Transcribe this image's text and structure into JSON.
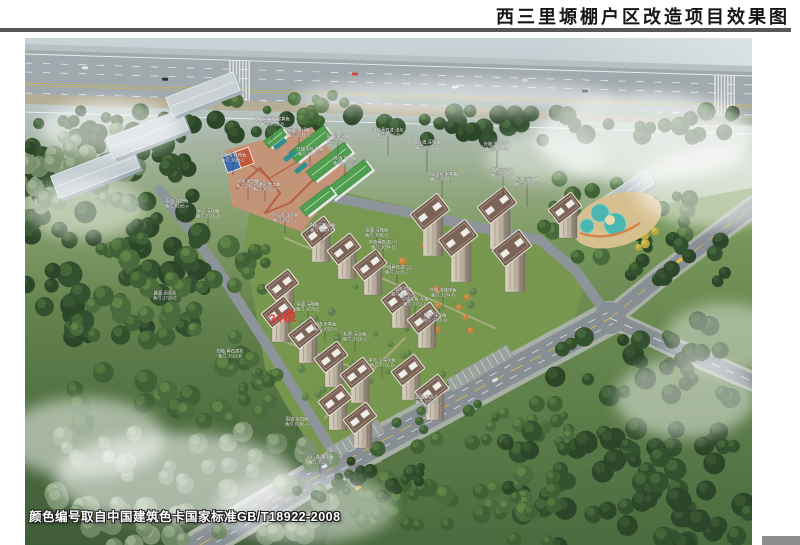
{
  "header": {
    "title": "西三里塬棚户区改造项目效果图"
  },
  "footer": {
    "color_note": "颜色编号取自中国建筑色卡国家标准GB/T18922-2008"
  },
  "scene": {
    "red_building_label": "3#楼",
    "colors": {
      "title_text": "#161616",
      "divider": "#575757",
      "roof_brown": "#6f584c",
      "wall_tan": "#c2b8a6",
      "school_roof_green": "#4f9f4f",
      "road_gray": "#878f95",
      "grass_green": "#5a7d47",
      "fog_white": "#ffffff",
      "red_label": "#e23228",
      "annotation_text": "#ffffff"
    },
    "annotations": [
      {
        "x": 247,
        "y": 84,
        "l1": "幼儿园外墙:暖黄色",
        "l2": "色号:1012-B",
        "d": 16
      },
      {
        "x": 274,
        "y": 95,
        "l1": "屋面:果绿色",
        "l2": "色号:2258-C",
        "d": 14
      },
      {
        "x": 285,
        "y": 114,
        "l1": "外墙涂料:白色",
        "l2": "色号:0101-A",
        "d": 12
      },
      {
        "x": 313,
        "y": 101,
        "l1": "屋面:果绿色",
        "l2": "色号:2260-B",
        "d": 16
      },
      {
        "x": 320,
        "y": 123,
        "l1": "外墙:米白色",
        "l2": "色号:0912-A",
        "d": 12
      },
      {
        "x": 363,
        "y": 95,
        "l1": "外墙真石漆:浅灰",
        "l2": "色号:2712-B",
        "d": 20
      },
      {
        "x": 402,
        "y": 107,
        "l1": "女儿墙:深咖色",
        "l2": "色号:1679-D",
        "d": 24
      },
      {
        "x": 417,
        "y": 139,
        "l1": "外墙涂料:米黄色",
        "l2": "色号:1034-A",
        "d": 18
      },
      {
        "x": 472,
        "y": 109,
        "l1": "外墙:浅咖啡色",
        "l2": "色号:1275-B",
        "d": 26
      },
      {
        "x": 478,
        "y": 135,
        "l1": "窗框:深灰色",
        "l2": "色号:2719-D",
        "d": 18
      },
      {
        "x": 502,
        "y": 144,
        "l1": "栏杆:深灰色",
        "l2": "色号:2718-C",
        "d": 22
      },
      {
        "x": 152,
        "y": 166,
        "l1": "围墙:灰白色",
        "l2": "色号:0205-A",
        "d": 14
      },
      {
        "x": 183,
        "y": 176,
        "l1": "大门:深灰色",
        "l2": "色号:2715-D",
        "d": 12
      },
      {
        "x": 208,
        "y": 120,
        "l1": "透水砖:红褐色",
        "l2": "色号:1818-C",
        "d": 14
      },
      {
        "x": 240,
        "y": 149,
        "l1": "广场铺装:陶土色",
        "l2": "色号:1526-B",
        "d": 12
      },
      {
        "x": 260,
        "y": 180,
        "l1": "人行道:浅灰色",
        "l2": "色号:2513-A",
        "d": 12
      },
      {
        "x": 297,
        "y": 190,
        "l1": "道路沿石:灰色",
        "l2": "色号:2514-B",
        "d": 12
      },
      {
        "x": 140,
        "y": 258,
        "l1": "路面:沥青灰",
        "l2": "色号:2720-E",
        "d": 12
      },
      {
        "x": 223,
        "y": 146,
        "l1": "外墙:米白色",
        "l2": "色号:0911-A",
        "d": 12
      },
      {
        "x": 352,
        "y": 195,
        "l1": "屋面:深咖色",
        "l2": "色号:1680-E",
        "d": 16
      },
      {
        "x": 358,
        "y": 207,
        "l1": "外墙真石漆(一)",
        "l2": "色号:1034-B",
        "d": 14
      },
      {
        "x": 372,
        "y": 232,
        "l1": "外墙真石漆(二)",
        "l2": "色号:1275-C",
        "d": 14
      },
      {
        "x": 378,
        "y": 254,
        "l1": "线脚:白色",
        "l2": "色号:0105-A",
        "d": 12
      },
      {
        "x": 390,
        "y": 264,
        "l1": "空调栏板:灰色",
        "l2": "色号:2712-C",
        "d": 12
      },
      {
        "x": 418,
        "y": 255,
        "l1": "外墙:浅咖啡色",
        "l2": "色号:1274-B",
        "d": 14
      },
      {
        "x": 410,
        "y": 280,
        "l1": "窗框:深灰色",
        "l2": "色号:2719-D",
        "d": 12
      },
      {
        "x": 283,
        "y": 269,
        "l1": "屋面:深咖色",
        "l2": "色号:1679-E",
        "d": 12
      },
      {
        "x": 300,
        "y": 289,
        "l1": "外墙:米黄色",
        "l2": "色号:1033-A",
        "d": 12
      },
      {
        "x": 330,
        "y": 299,
        "l1": "栏杆:深灰色",
        "l2": "色号:2718-C",
        "d": 12
      },
      {
        "x": 357,
        "y": 325,
        "l1": "单元门:深灰色",
        "l2": "色号:2716-D",
        "d": 12
      },
      {
        "x": 402,
        "y": 362,
        "l1": "道路:沥青灰",
        "l2": "色号:2720-E",
        "d": 10
      },
      {
        "x": 272,
        "y": 384,
        "l1": "围墙:灰白色",
        "l2": "色号:0206-A",
        "d": 10
      },
      {
        "x": 295,
        "y": 422,
        "l1": "人行道:浅灰色",
        "l2": "色号:2513-B",
        "d": 10
      },
      {
        "x": 205,
        "y": 316,
        "l1": "挡墙:真石漆灰",
        "l2": "色号:2613-B",
        "d": 10
      }
    ],
    "towers": [
      {
        "x": 293,
        "y": 194
      },
      {
        "x": 319,
        "y": 211
      },
      {
        "x": 345,
        "y": 227
      },
      {
        "x": 257,
        "y": 247
      },
      {
        "x": 253,
        "y": 274
      },
      {
        "x": 280,
        "y": 295
      },
      {
        "x": 306,
        "y": 319
      },
      {
        "x": 332,
        "y": 335
      },
      {
        "x": 310,
        "y": 362
      },
      {
        "x": 335,
        "y": 380
      },
      {
        "x": 373,
        "y": 260
      },
      {
        "x": 399,
        "y": 280
      },
      {
        "x": 405,
        "y": 174,
        "t": 1
      },
      {
        "x": 433,
        "y": 200,
        "t": 1
      },
      {
        "x": 472,
        "y": 167,
        "t": 1
      },
      {
        "x": 487,
        "y": 210,
        "t": 1
      },
      {
        "x": 540,
        "y": 170
      },
      {
        "x": 383,
        "y": 332
      },
      {
        "x": 407,
        "y": 352
      }
    ]
  }
}
